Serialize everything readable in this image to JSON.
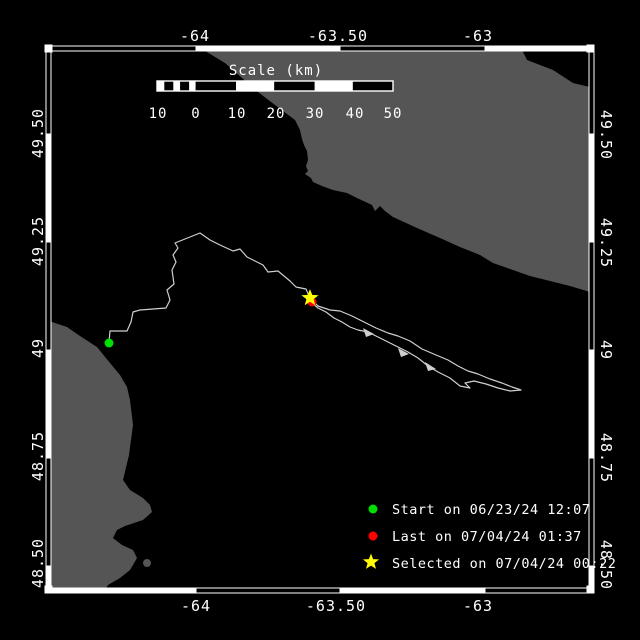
{
  "window": {
    "title": "Drifter track map"
  },
  "colors": {
    "background": "#000000",
    "land": "#555555",
    "sea": "#000000",
    "frame": "#ffffff",
    "track": "#cfcfcf",
    "start": "#00dd00",
    "last": "#ff0000",
    "selected": "#ffff00",
    "text": "#ffffff"
  },
  "axis_labels": {
    "top": [
      "-64",
      "-63.50",
      "-63"
    ],
    "bottom": [
      "-64",
      "-63.50",
      "-63"
    ],
    "left": [
      "49.50",
      "49.25",
      "49",
      "48.75",
      "48.50"
    ],
    "right": [
      "49.50",
      "49.25",
      "49",
      "48.75",
      "48.50"
    ]
  },
  "scalebar": {
    "title": "Scale (km)",
    "tick_labels": [
      "10",
      "0",
      "10",
      "20",
      "30",
      "40",
      "50"
    ]
  },
  "legend": [
    {
      "marker": "circle",
      "color": "#00dd00",
      "label": "Start on 06/23/24 12:07"
    },
    {
      "marker": "circle",
      "color": "#ff0000",
      "label": "Last on 07/04/24 01:37"
    },
    {
      "marker": "star",
      "color": "#ffff00",
      "label": "Selected on 07/04/24 00:22"
    }
  ]
}
